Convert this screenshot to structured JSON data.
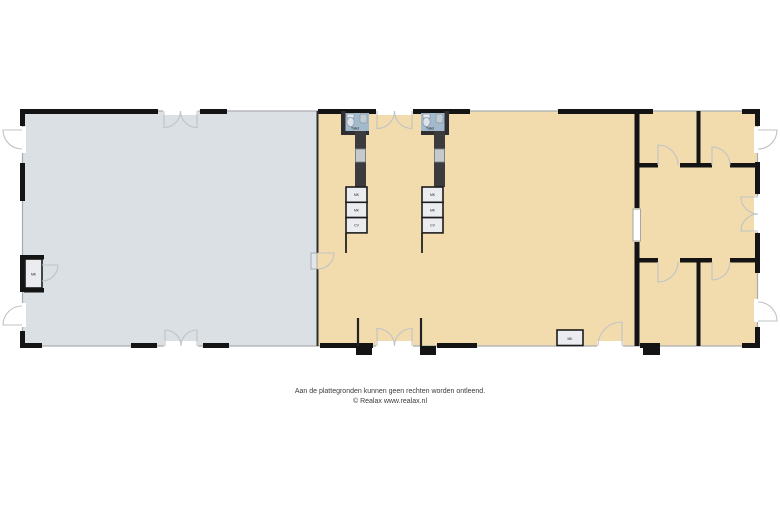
{
  "footer": {
    "disclaimer": "Aan de plattegronden kunnen geen rechten worden ontleend.",
    "copyright": "© Realax www.realax.nl"
  },
  "labels": {
    "toilet_left": "Toilet",
    "toilet_right": "Toilet",
    "closet": "MK",
    "hall_box": "MK",
    "left_unit_boxes": [
      "MK",
      "MK",
      "CV"
    ],
    "right_unit_boxes": [
      "MK",
      "MK",
      "CV"
    ]
  },
  "colors": {
    "background": "#ffffff",
    "warehouse_floor": "#dbe0e4",
    "hall_floor": "#f2dcae",
    "office_floor": "#f2dcae",
    "toilet_floor": "#a3b9cc",
    "wall": "#141414",
    "thin_wall": "#a7abaf",
    "door_arc": "#bfc3c6",
    "fixture_fill": "#eaecef"
  }
}
